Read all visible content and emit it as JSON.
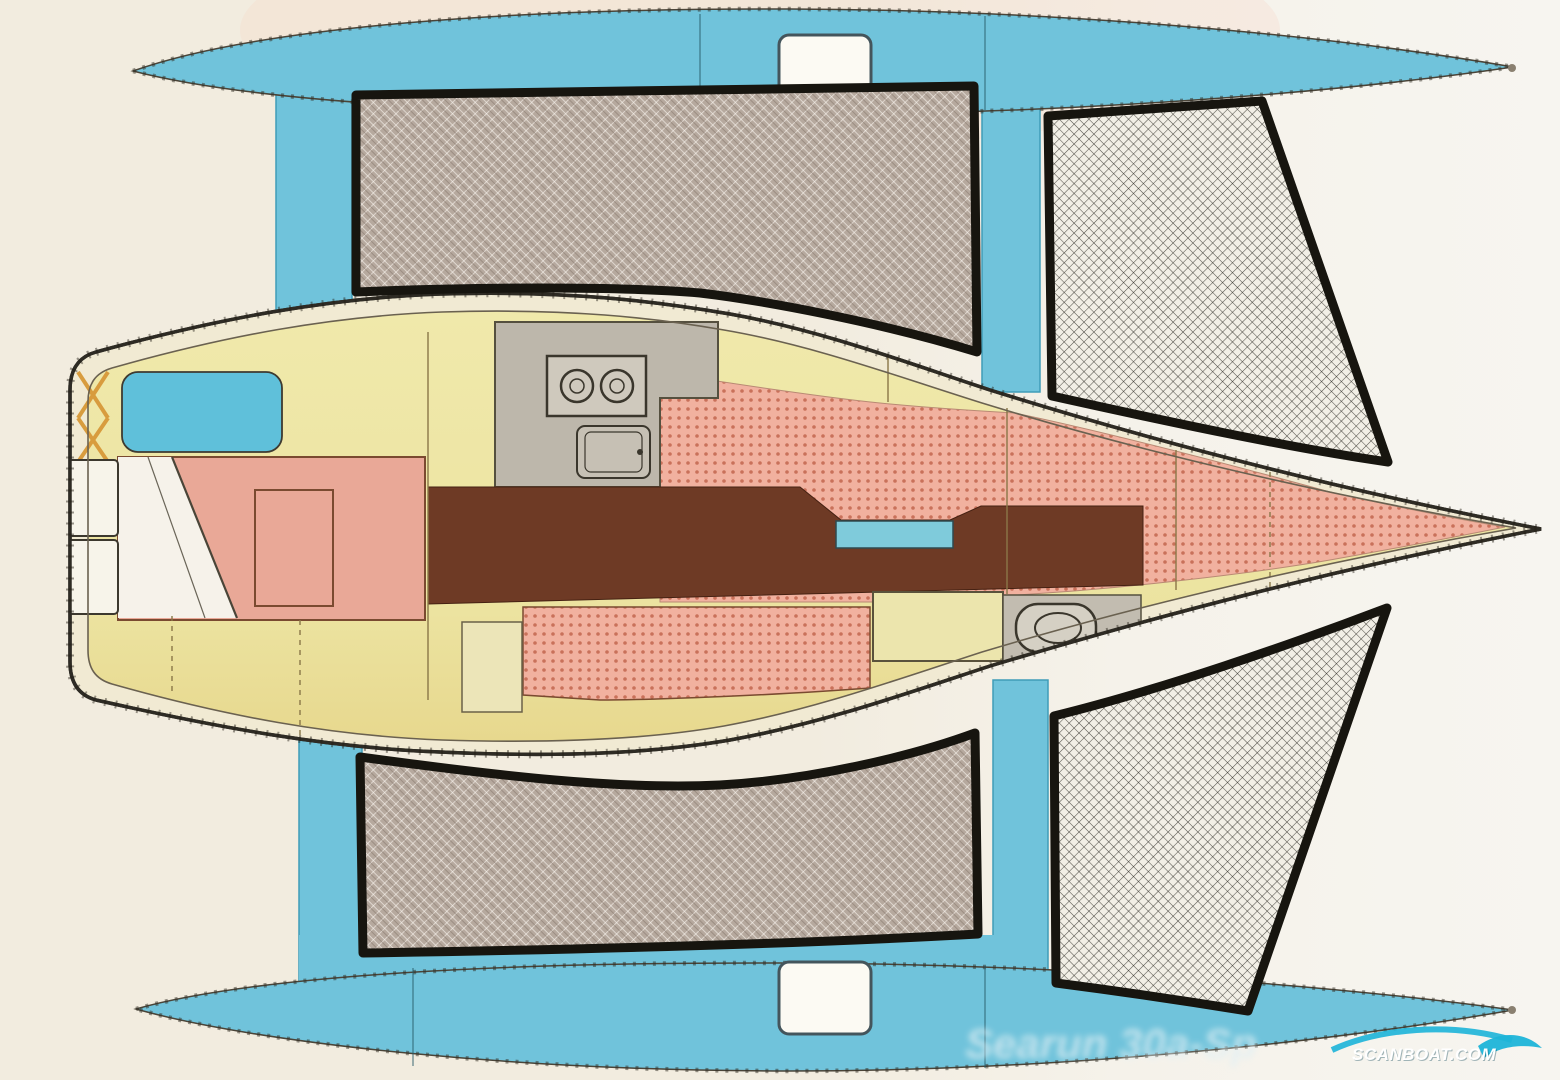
{
  "meta": {
    "diagram_type": "boat-floor-plan",
    "subject": "trimaran sailboat — top view deck and interior accommodation plan"
  },
  "watermark": {
    "site": "SCANBOAT.COM",
    "faint_text": "Searun 30a-Sp",
    "wave_color": "#1db4d8",
    "text_color": "#ffffff"
  },
  "parts": {
    "main_hull": "main hull (vaka) with cabin accommodation",
    "top_float": "port float (ama)",
    "bottom_float": "starboard float (ama)",
    "crossbeams": "four crossbeams (akas) joining floats to hull",
    "nettings": "four trampoline nets between hull and floats",
    "aft_cabin": "aft double berth with pillows and folded sheet",
    "galley": "galley with two-burner stove and sink",
    "saloon": "settee berths amidships (dotted upholstery)",
    "sole": "cabin sole walkway",
    "head": "fore toilet compartment",
    "v_berth": "forward V-berth tapering to bow",
    "hatches": "deck hatches on each float"
  },
  "colors": {
    "background": "#f2ecdf",
    "float_blue": "#70c3db",
    "hull_deck_cream": "#f1ead3",
    "cabin_yellow": "#eee7a3",
    "berth_pink": "#f1b19f",
    "berth_dot": "#c9715a",
    "sole_brown": "#6e3a25",
    "galley_gray": "#bdb7ab",
    "net_taupe": "#b6a99e",
    "net_white": "#f2efe6",
    "outline_black": "#17150f"
  }
}
